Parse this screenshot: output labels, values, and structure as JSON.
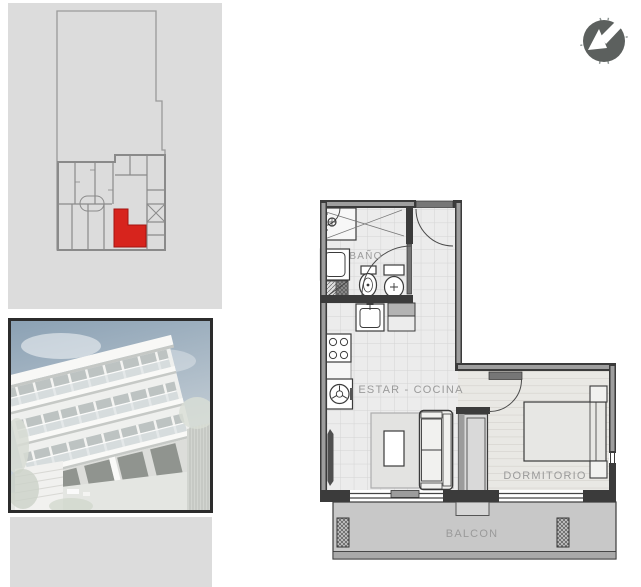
{
  "palette": {
    "page-bg": "#ffffff",
    "panel-bg": "#dcdcdc",
    "lot-line": "#9a9a9a",
    "keyplan-wall": "#8a8a8a",
    "unit-highlight": "#d7241d",
    "unit-highlight-edge": "#a31511",
    "wall-dark": "#3b3b3b",
    "wall-core": "#9e9e9e",
    "floor-fill": "#ececec",
    "tile-line": "#d4d4d4",
    "wood-fill": "#e9e8e4",
    "wood-line": "#cfccc6",
    "balcony-fill": "#c8c8c8",
    "balcony-edge": "#a9a9a9",
    "door-leaf": "#767676",
    "label-color": "#9a9a9a",
    "compass-bg": "#5c605e",
    "compass-arrow": "#ffffff",
    "photo-border": "#2c2c2c",
    "sky-top": "#8ba1b4",
    "sky-bottom": "#d6dce0",
    "building-white": "#eff0ee"
  },
  "floor_plan": {
    "labels": {
      "bathroom": "BAÑO",
      "living_kitchen": "ESTAR - COCINA",
      "bedroom": "DORMITORIO",
      "balcony": "BALCON"
    }
  }
}
